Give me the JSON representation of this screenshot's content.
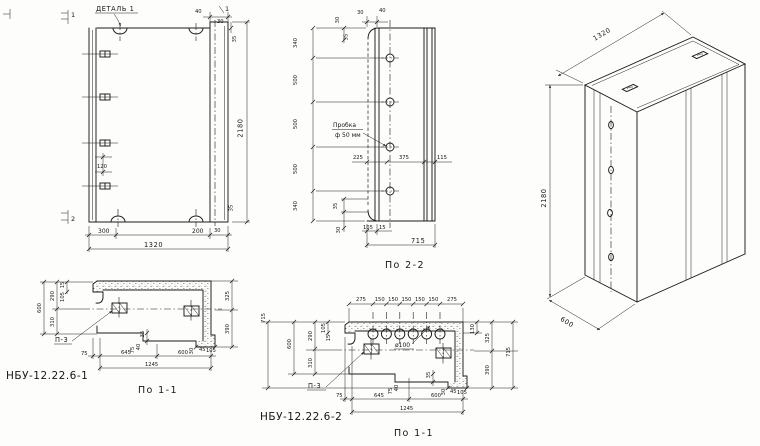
{
  "elevation": {
    "detail_callout": "ДЕТАЛЬ 1",
    "marks": {
      "one_left": "1",
      "one_right": "1",
      "two": "2"
    },
    "dims": {
      "top_40": "40",
      "top_30": "30",
      "top_35": "35",
      "height": "2180",
      "embed_gap": "120",
      "bottom_300": "300",
      "bottom_200": "200",
      "bottom_width": "1320",
      "corner_35": "35",
      "corner_30": "30"
    }
  },
  "section_2_2": {
    "caption": "По 2-2",
    "plug_note_line1": "Пробка",
    "plug_note_line2": "ф 50 мм",
    "dims": {
      "top_30": "30",
      "top_40": "40",
      "edge_30": "30",
      "edge_35": "35",
      "chain": [
        "340",
        "500",
        "500",
        "500",
        "340"
      ],
      "width_225": "225",
      "width_375": "375",
      "width_115": "115",
      "foot_35": "35",
      "foot_30": "30",
      "bottom_105": "105",
      "bottom_15": "15",
      "depth": "715"
    }
  },
  "isometric": {
    "dims": {
      "width": "1320",
      "height": "2180",
      "depth": "600"
    }
  },
  "plan_1": {
    "part_mark": "НБУ-12.22.6-1",
    "caption": "По 1-1",
    "embed_callout": "П-3",
    "dims": {
      "left_600": "600",
      "left_290": "290",
      "left_310": "310",
      "left_15": "15",
      "left_105": "105",
      "right_325": "325",
      "right_390": "390",
      "bottom_75": "75",
      "bottom_645": "645",
      "bottom_600": "600",
      "bottom_1245": "1245",
      "step_35": "35",
      "step_75": "75",
      "step_40": "40",
      "foot_30": "30",
      "foot_45": "45",
      "foot_105": "105"
    }
  },
  "plan_2": {
    "part_mark": "НБУ-12.22.6-2",
    "caption": "По 1-1",
    "embed_callout": "П-3",
    "hole_callout": "ø100",
    "dims": {
      "top_chain": [
        "275",
        "150",
        "150",
        "150",
        "150",
        "150",
        "275"
      ],
      "left_715": "715",
      "left_600": "600",
      "left_290": "290",
      "left_310": "310",
      "left_105": "105",
      "left_15": "15",
      "right_130": "130",
      "right_325": "325",
      "right_390": "390",
      "right_715": "715",
      "bottom_75": "75",
      "bottom_645": "645",
      "bottom_600": "600",
      "bottom_1245": "1245",
      "step_35": "35",
      "step_75": "75",
      "step_40": "40",
      "foot_30": "30",
      "foot_45": "45",
      "foot_105": "105"
    }
  }
}
